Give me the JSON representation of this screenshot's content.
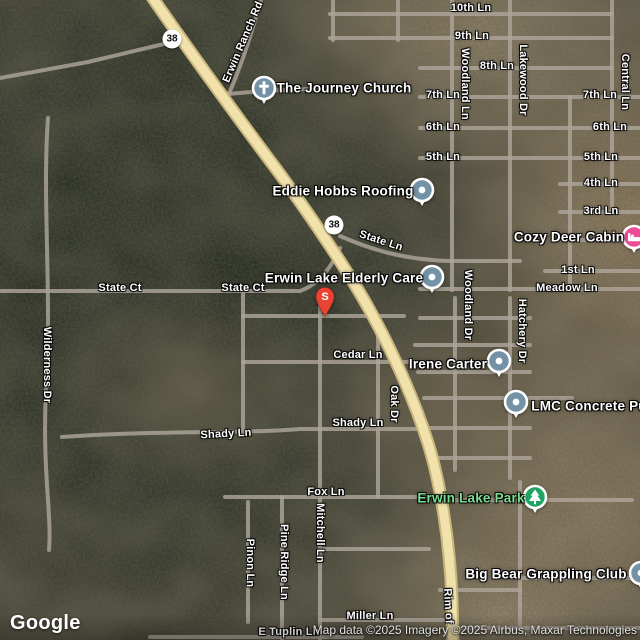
{
  "attribution": {
    "logo": "Google",
    "copyright": "Map data ©2025 Imagery ©2025 Airbus, Maxar Technologies"
  },
  "colors": {
    "poi_generic": "#7492a6",
    "poi_lodging": "#ec4d96",
    "poi_park": "#1fa463",
    "park_text": "#7ade90",
    "pin_red": "#EA4335",
    "highway_fill": "#f1e2ac",
    "highway_casing": "#c9b67e",
    "minor_road": "#ada59a"
  },
  "pin": {
    "label": "S",
    "x": 325,
    "y": 316
  },
  "shields": [
    {
      "label": "38",
      "x": 172,
      "y": 39
    },
    {
      "label": "38",
      "x": 334,
      "y": 225
    }
  ],
  "street_labels": [
    {
      "text": "10th Ln",
      "x": 471,
      "y": 8,
      "rot": 0
    },
    {
      "text": "9th Ln",
      "x": 472,
      "y": 36,
      "rot": 0
    },
    {
      "text": "8th Ln",
      "x": 497,
      "y": 66,
      "rot": 0
    },
    {
      "text": "7th Ln",
      "x": 443,
      "y": 95,
      "rot": 0
    },
    {
      "text": "7th Ln",
      "x": 600,
      "y": 95,
      "rot": 0
    },
    {
      "text": "6th Ln",
      "x": 443,
      "y": 127,
      "rot": 0
    },
    {
      "text": "6th Ln",
      "x": 610,
      "y": 127,
      "rot": 0
    },
    {
      "text": "5th Ln",
      "x": 443,
      "y": 157,
      "rot": 0
    },
    {
      "text": "5th Ln",
      "x": 601,
      "y": 157,
      "rot": 0
    },
    {
      "text": "4th Ln",
      "x": 601,
      "y": 183,
      "rot": 0
    },
    {
      "text": "3rd Ln",
      "x": 601,
      "y": 211,
      "rot": 0
    },
    {
      "text": "1st Ln",
      "x": 578,
      "y": 270,
      "rot": 0
    },
    {
      "text": "Meadow Ln",
      "x": 567,
      "y": 288,
      "rot": 0
    },
    {
      "text": "Woodland Ln",
      "x": 465,
      "y": 84,
      "rot": 90
    },
    {
      "text": "Lakewood Dr",
      "x": 523,
      "y": 80,
      "rot": 90
    },
    {
      "text": "Central Ln",
      "x": 625,
      "y": 82,
      "rot": 90
    },
    {
      "text": "Woodland Dr",
      "x": 468,
      "y": 305,
      "rot": 90
    },
    {
      "text": "Hatchery Dr",
      "x": 522,
      "y": 331,
      "rot": 90
    },
    {
      "text": "Erwin Ranch Rd",
      "x": 243,
      "y": 42,
      "rot": -67
    },
    {
      "text": "State Ln",
      "x": 381,
      "y": 241,
      "rot": 18
    },
    {
      "text": "State Ct",
      "x": 120,
      "y": 288,
      "rot": 0
    },
    {
      "text": "State Ct",
      "x": 243,
      "y": 288,
      "rot": 0
    },
    {
      "text": "Wilderness Dr",
      "x": 47,
      "y": 365,
      "rot": 90
    },
    {
      "text": "Cedar Ln",
      "x": 358,
      "y": 355,
      "rot": 0
    },
    {
      "text": "Oak Dr",
      "x": 394,
      "y": 404,
      "rot": 90
    },
    {
      "text": "Shady Ln",
      "x": 226,
      "y": 434,
      "rot": -3
    },
    {
      "text": "Shady Ln",
      "x": 358,
      "y": 423,
      "rot": 0
    },
    {
      "text": "Fox Ln",
      "x": 326,
      "y": 492,
      "rot": 0
    },
    {
      "text": "Mitchell Ln",
      "x": 320,
      "y": 533,
      "rot": 90
    },
    {
      "text": "Pine Ridge Ln",
      "x": 284,
      "y": 562,
      "rot": 90
    },
    {
      "text": "Pinon Ln",
      "x": 250,
      "y": 563,
      "rot": 90
    },
    {
      "text": "Miller Ln",
      "x": 370,
      "y": 616,
      "rot": 0
    },
    {
      "text": "E Tuplin Ln",
      "x": 289,
      "y": 632,
      "rot": 0
    },
    {
      "text": "Rim of",
      "x": 448,
      "y": 606,
      "rot": 87
    }
  ],
  "pois": [
    {
      "name": "the-journey-church",
      "label": "The Journey Church",
      "icon": "cross",
      "color": "#7492a6",
      "marker": {
        "x": 264,
        "y": 88
      },
      "text": {
        "x": 344,
        "y": 88
      }
    },
    {
      "name": "eddie-hobbs-roofing",
      "label": "Eddie Hobbs Roofing",
      "icon": "dot",
      "color": "#7492a6",
      "marker": {
        "x": 422,
        "y": 190
      },
      "text": {
        "x": 343,
        "y": 191
      }
    },
    {
      "name": "erwin-lake-elderly-care",
      "label": "Erwin Lake Elderly Care",
      "icon": "dot",
      "color": "#7492a6",
      "marker": {
        "x": 432,
        "y": 277
      },
      "text": {
        "x": 344,
        "y": 278
      }
    },
    {
      "name": "cozy-deer-cabin",
      "label": "Cozy Deer Cabin",
      "icon": "bed",
      "color": "#ec4d96",
      "marker": {
        "x": 634,
        "y": 237
      },
      "text": {
        "x": 569,
        "y": 237
      }
    },
    {
      "name": "irene-carter",
      "label": "Irene Carter",
      "icon": "dot",
      "color": "#7492a6",
      "marker": {
        "x": 499,
        "y": 361
      },
      "text": {
        "x": 448,
        "y": 364
      }
    },
    {
      "name": "lmc-concrete",
      "label": "LMC Concrete Pu",
      "icon": "dot",
      "color": "#7492a6",
      "marker": {
        "x": 516,
        "y": 402
      },
      "text": {
        "x": 589,
        "y": 406
      }
    },
    {
      "name": "erwin-lake-park",
      "label": "Erwin Lake Park",
      "icon": "tree",
      "color": "#1fa463",
      "text_color": "#7ade90",
      "marker": {
        "x": 535,
        "y": 497
      },
      "text": {
        "x": 471,
        "y": 498
      }
    },
    {
      "name": "big-bear-grappling-club",
      "label": "Big Bear Grappling Club",
      "icon": "dot",
      "color": "#7492a6",
      "marker": {
        "x": 641,
        "y": 573
      },
      "text": {
        "x": 546,
        "y": 574
      }
    }
  ]
}
